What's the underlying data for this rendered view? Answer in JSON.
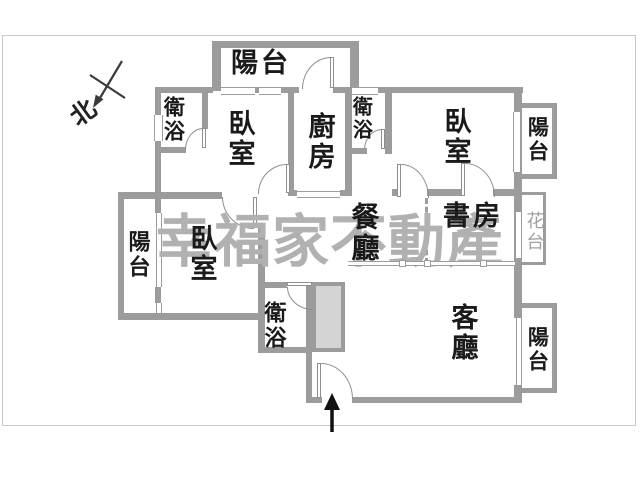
{
  "floorplan": {
    "watermark_text": "幸福家不動產",
    "compass": {
      "label": "北"
    },
    "rooms": {
      "balcony_top": "陽台",
      "bath_top_left": "衛浴",
      "bedroom_top_left": "臥室",
      "kitchen": "廚房",
      "bath_top_mid": "衛浴",
      "bedroom_top_right": "臥室",
      "balcony_right": "陽台",
      "balcony_left": "陽台",
      "bedroom_left": "臥室",
      "dining": "餐廳",
      "study": "書房",
      "flower_stand": "花台",
      "bath_bottom": "衛浴",
      "living_room": "客廳",
      "balcony_bottom_right": "陽台"
    },
    "colors": {
      "wall": "#9c9c9c",
      "arc": "#8f8f8f",
      "watermark": "#b1b1b1",
      "label": "#1a1a1a",
      "flower_label": "#a0a0a0",
      "shaft_fill": "#d4d4d4",
      "frame": "#c9c9c9",
      "background": "#ffffff"
    }
  }
}
